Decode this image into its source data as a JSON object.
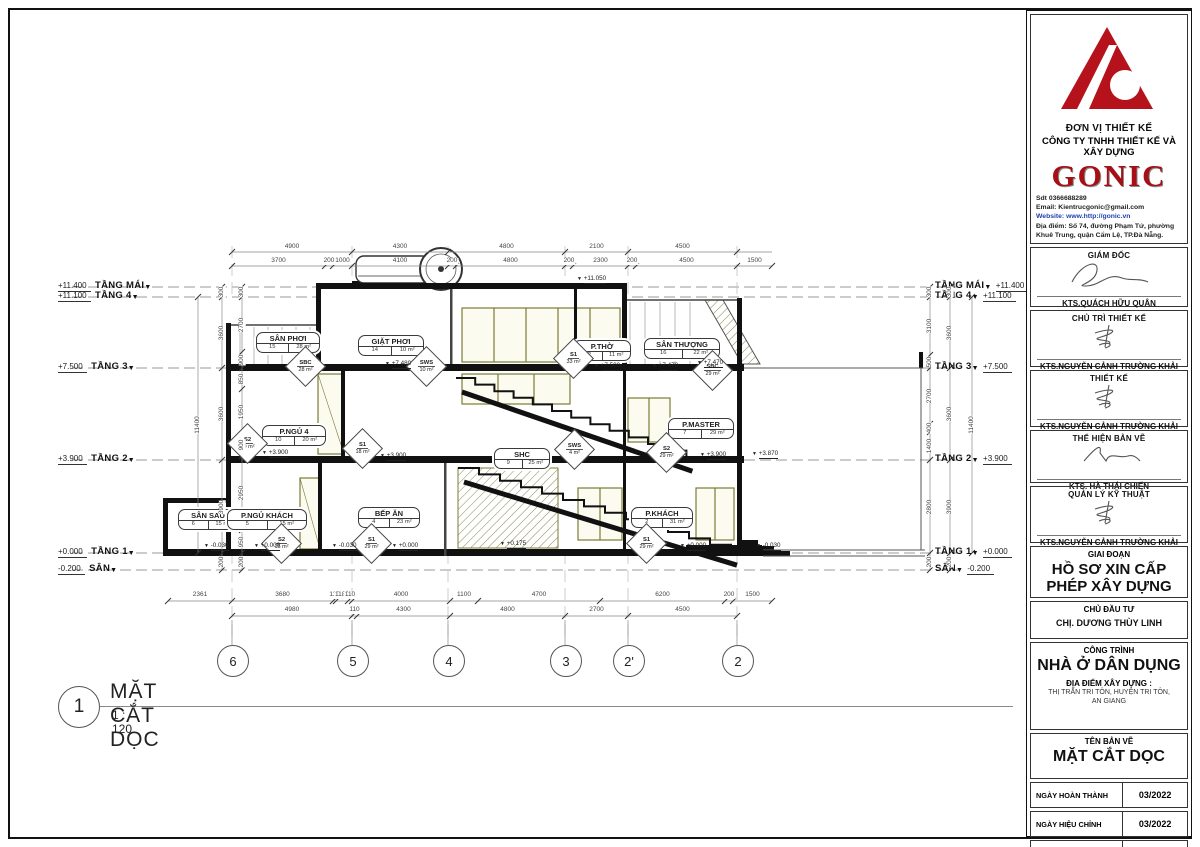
{
  "colors": {
    "logo_red": "#b5121b",
    "line": "#444444",
    "olive": "#7b7b35"
  },
  "view": {
    "number": "1",
    "title": "MẶT CẮT DỌC",
    "scale": "1 : 120"
  },
  "drawing": {
    "grids": [
      "6",
      "5",
      "4",
      "3",
      "2'",
      "2"
    ],
    "levels": [
      {
        "value": "+11.400",
        "name": "TẦNG MÁI"
      },
      {
        "value": "+11.100",
        "name": "TẦNG 4"
      },
      {
        "value": "+7.500",
        "name": "TẦNG 3"
      },
      {
        "value": "+3.900",
        "name": "TẦNG 2"
      },
      {
        "value": "+0.000",
        "name": "TẦNG 1"
      },
      {
        "value": "-0.200",
        "name": "SÂN"
      }
    ],
    "rooms": [
      {
        "name": "SÂN PHƠI",
        "num": "15",
        "area": "28 m²"
      },
      {
        "name": "GIẶT PHƠI",
        "num": "14",
        "area": "10 m²"
      },
      {
        "name": "P.THỜ",
        "num": "12",
        "area": "11 m²"
      },
      {
        "name": "SÂN THƯỢNG",
        "num": "16",
        "area": "22 m²"
      },
      {
        "name": "P.NGỦ 4",
        "num": "10",
        "area": "20 m²"
      },
      {
        "name": "SHC",
        "num": "9",
        "area": "25 m²"
      },
      {
        "name": "P.MASTER",
        "num": "7",
        "area": "29 m²"
      },
      {
        "name": "SÂN SAU",
        "num": "6",
        "area": "15 m²"
      },
      {
        "name": "P.NGỦ KHÁCH",
        "num": "5",
        "area": "15 m²"
      },
      {
        "name": "BẾP ĂN",
        "num": "4",
        "area": "23 m²"
      },
      {
        "name": "P.KHÁCH",
        "num": "2",
        "area": "31 m²"
      }
    ],
    "tags": [
      {
        "code": "SBC",
        "area": "28 m²"
      },
      {
        "code": "SWS",
        "area": "10 m²"
      },
      {
        "code": "S1",
        "area": "33 m²"
      },
      {
        "code": "SBC",
        "area": "29 m²"
      },
      {
        "code": "S2",
        "area": "20 m²"
      },
      {
        "code": "S1",
        "area": "18 m²"
      },
      {
        "code": "SWS",
        "area": "4 m²"
      },
      {
        "code": "S2",
        "area": "29 m²"
      },
      {
        "code": "S2",
        "area": "15 m²"
      },
      {
        "code": "S1",
        "area": "29 m²"
      },
      {
        "code": "S1",
        "area": "29 m²"
      }
    ],
    "spot_levels": [
      "+11.050",
      "+7.480",
      "+7.500",
      "+7.470",
      "+7.470",
      "+3.900",
      "+3.900",
      "+3.900",
      "+3.870",
      "-0.030",
      "+0.000",
      "-0.030",
      "+0.000",
      "+0.175",
      "+0.000",
      "-0.030"
    ],
    "dims_top_row1": [
      "4900",
      "4300",
      "4800",
      "2100",
      "4500"
    ],
    "dims_top_row2": [
      "3700",
      "200",
      "1000",
      "4100",
      "200",
      "4800",
      "200",
      "2300",
      "200",
      "4500",
      "1500"
    ],
    "dims_bottom_row1": [
      "2361",
      "3680",
      "110",
      "1180",
      "110",
      "4000",
      "1100",
      "4700",
      "6200",
      "200",
      "1500"
    ],
    "dims_bottom_row2": [
      "4980",
      "110",
      "4300",
      "4800",
      "2700",
      "4500"
    ],
    "dims_left_fine": [
      "300",
      "2700",
      "900",
      "850",
      "1950",
      "900",
      "2950",
      "950",
      "200"
    ],
    "dims_left_floors": [
      "300",
      "3600",
      "3600",
      "3900",
      "200"
    ],
    "dims_left_overall": [
      "11400"
    ],
    "dims_right_fine": [
      "300",
      "3100",
      "500",
      "2700",
      "400",
      "1400",
      "2800",
      "200"
    ],
    "dims_right_floors": [
      "300",
      "3600",
      "3600",
      "3900",
      "200"
    ],
    "dims_right_overall": [
      "11400"
    ]
  },
  "title_block": {
    "don_vi": "ĐƠN VỊ THIẾT KẾ",
    "company": "CÔNG TY TNHH THIẾT KẾ VÀ XÂY DỰNG",
    "brand": "GONIC",
    "phone": "Sdt 0366688289",
    "email": "Email: Kientrucgonic@gmail.com",
    "website": "Website: www.http://gonic.vn",
    "address": "Địa điểm: Số 74, đường Phạm Tứ, phường Khuê Trung, quận Cẩm Lệ, TP.Đà Nẵng.",
    "roles": [
      {
        "title": "GIÁM ĐỐC",
        "name": "KTS.QUÁCH HỮU QUÂN"
      },
      {
        "title": "CHỦ TRÌ THIẾT KẾ",
        "name": "KTS.NGUYỄN CẢNH TRƯỜNG KHẢI"
      },
      {
        "title": "THIẾT KẾ",
        "name": "KTS.NGUYỄN CẢNH TRƯỜNG KHẢI"
      },
      {
        "title": "THỂ HIỆN BẢN VẼ",
        "name": "KTS. HÀ THÁI CHIẾN"
      },
      {
        "title": "QUẢN LÝ KỸ THUẬT",
        "name": "KTS.NGUYỄN CẢNH TRƯỜNG KHẢI"
      }
    ],
    "giai_doan_label": "GIAI ĐOẠN",
    "giai_doan_line1": "HỒ SƠ XIN CẤP",
    "giai_doan_line2": "PHÉP XÂY DỰNG",
    "chu_dau_tu_label": "CHỦ ĐẦU TƯ",
    "chu_dau_tu": "CHỊ. DƯƠNG THÙY LINH",
    "cong_trinh_label": "CÔNG TRÌNH",
    "cong_trinh": "NHÀ Ở DÂN DỤNG",
    "dia_diem_label": "ĐỊA ĐIỂM XÂY DỰNG :",
    "dia_diem_line1": "THỊ TRẤN TRI TÔN, HUYỆN TRI TÔN,",
    "dia_diem_line2": "AN GIANG",
    "ten_ban_ve_label": "TÊN BẢN VẼ",
    "ten_ban_ve": "MẶT CẮT DỌC",
    "rows": [
      {
        "label": "NGÀY HOÀN THÀNH",
        "value": "03/2022"
      },
      {
        "label": "NGÀY HIỆU CHỈNH",
        "value": "03/2022"
      },
      {
        "label": "KÍ HIỆU BẢN VẼ",
        "value": "KT V08"
      }
    ]
  }
}
